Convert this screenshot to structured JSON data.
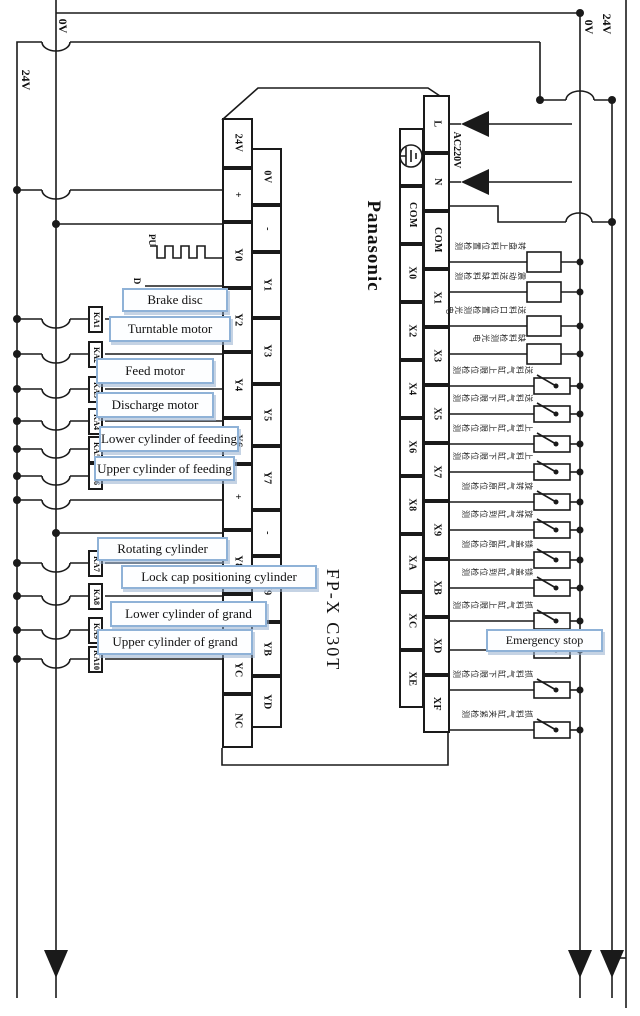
{
  "diagram": {
    "power_rails": {
      "left_24v": "24V",
      "left_0v": "0V",
      "right_0v": "0V",
      "right_24v": "24V"
    },
    "plc": {
      "brand": "Panasonic",
      "model": "FP-X C30T",
      "power_label": "AC220V",
      "pulse_signal": "PU",
      "direction_signal": "D",
      "output_terminals_left": [
        "24V",
        "+",
        "Y0",
        "Y2",
        "Y4",
        "Y6",
        "+",
        "Y8",
        "YA",
        "YC",
        "NC"
      ],
      "output_terminals_right": [
        "0V",
        "-",
        "Y1",
        "Y3",
        "Y5",
        "Y7",
        "-",
        "Y9",
        "YB",
        "YD"
      ],
      "input_terminals_left": [
        "",
        "COM",
        "X0",
        "X2",
        "X4",
        "X6",
        "X8",
        "XA",
        "XC",
        "XE"
      ],
      "input_terminals_right": [
        "L",
        "N",
        "COM",
        "X1",
        "X3",
        "X5",
        "X7",
        "X9",
        "XB",
        "XD",
        "XF"
      ]
    },
    "relays": [
      "KA1",
      "KA2",
      "KA3",
      "KA4",
      "KA5",
      "KA6",
      "KA7",
      "KA8",
      "KA9",
      "KA10"
    ],
    "output_device_labels": [
      "Brake disc",
      "Turntable motor",
      "Feed motor",
      "Discharge motor",
      "Lower cylinder of feeding",
      "Upper cylinder of feeding",
      "Rotating cylinder",
      "Lock cap positioning cylinder",
      "Lower cylinder of grand",
      "Upper cylinder of grand"
    ],
    "emergency_stop_label": "Emergency stop",
    "input_sensor_descriptions": [
      {
        "input": "X0",
        "desc": "转盘上料位置检测",
        "symbol": "box"
      },
      {
        "input": "X1",
        "desc": "震动送料缺料检测",
        "symbol": "box"
      },
      {
        "input": "X2",
        "desc": "送料口位置检测光电",
        "symbol": "box"
      },
      {
        "input": "X3",
        "desc": "缺料检测光电",
        "symbol": "box"
      },
      {
        "input": "X4",
        "desc": "送料气缸上限位检测",
        "symbol": "switch"
      },
      {
        "input": "X5",
        "desc": "送料气缸下限位检测",
        "symbol": "switch"
      },
      {
        "input": "X6",
        "desc": "上料气缸上限位检测",
        "symbol": "switch"
      },
      {
        "input": "X7",
        "desc": "上料气缸下限位检测",
        "symbol": "switch"
      },
      {
        "input": "X8",
        "desc": "旋转气缸原位检测",
        "symbol": "switch"
      },
      {
        "input": "X9",
        "desc": "旋转气缸到位检测",
        "symbol": "switch"
      },
      {
        "input": "XA",
        "desc": "锁盖气缸原位检测",
        "symbol": "switch"
      },
      {
        "input": "XB",
        "desc": "锁盖气缸到位检测",
        "symbol": "switch"
      },
      {
        "input": "XC",
        "desc": "抓料气缸上限位检测",
        "symbol": "switch"
      },
      {
        "input": "XD",
        "desc": "",
        "symbol": "switch"
      },
      {
        "input": "XE",
        "desc": "抓料气缸下限位检测",
        "symbol": "switch"
      },
      {
        "input": "XF",
        "desc": "抓料气缸夹紧检测",
        "symbol": "switch"
      }
    ],
    "colors": {
      "line": "#1a1a1a",
      "label_box_border": "#8fb2d7",
      "label_box_fill": "#fdfeff"
    }
  }
}
